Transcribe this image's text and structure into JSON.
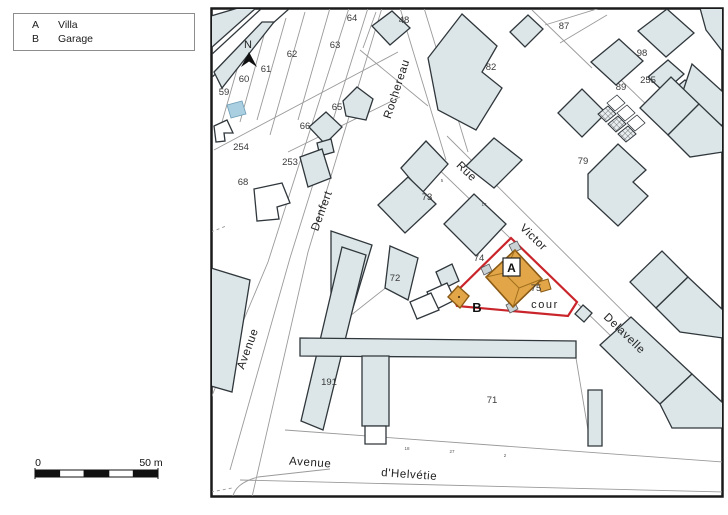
{
  "legend": {
    "items": [
      {
        "key": "A",
        "label": "Villa"
      },
      {
        "key": "B",
        "label": "Garage"
      }
    ]
  },
  "scale": {
    "zero": "0",
    "end": "50 m"
  },
  "north": "N",
  "area_label": "cour",
  "building_labels": {
    "a": "A",
    "b": "B"
  },
  "colors": {
    "building_fill": "#dce6e8",
    "building_stroke": "#30373c",
    "parcel_line": "#9a9a9a",
    "red_boundary": "#c9252b",
    "orange_fill": "#e2a648",
    "orange_stroke": "#8a5a15",
    "pool_blue": "#a9cfe0",
    "map_border": "#1a1a1a"
  },
  "street_labels": [
    {
      "text": "Rochereau",
      "x": 400,
      "y": 90,
      "rot": -72
    },
    {
      "text": "Denfert",
      "x": 325,
      "y": 212,
      "rot": -70
    },
    {
      "text": "Avenue",
      "x": 251,
      "y": 350,
      "rot": -70
    },
    {
      "text": "Rue",
      "x": 464,
      "y": 174,
      "rot": 44
    },
    {
      "text": "Victor",
      "x": 531,
      "y": 240,
      "rot": 44
    },
    {
      "text": "Delavelle",
      "x": 622,
      "y": 336,
      "rot": 44
    },
    {
      "text": "Avenue",
      "x": 310,
      "y": 466,
      "rot": 4
    },
    {
      "text": "d'Helvétie",
      "x": 409,
      "y": 478,
      "rot": 4
    }
  ],
  "parcel_labels": [
    {
      "text": "59",
      "x": 224,
      "y": 95
    },
    {
      "text": "60",
      "x": 244,
      "y": 82
    },
    {
      "text": "61",
      "x": 266,
      "y": 72
    },
    {
      "text": "62",
      "x": 292,
      "y": 57
    },
    {
      "text": "63",
      "x": 335,
      "y": 48
    },
    {
      "text": "64",
      "x": 352,
      "y": 21
    },
    {
      "text": "48",
      "x": 404,
      "y": 23
    },
    {
      "text": "87",
      "x": 564,
      "y": 29
    },
    {
      "text": "82",
      "x": 491,
      "y": 70
    },
    {
      "text": "98",
      "x": 642,
      "y": 56
    },
    {
      "text": "255",
      "x": 648,
      "y": 83
    },
    {
      "text": "89",
      "x": 621,
      "y": 90
    },
    {
      "text": "65",
      "x": 337,
      "y": 110
    },
    {
      "text": "66",
      "x": 305,
      "y": 129
    },
    {
      "text": "254",
      "x": 241,
      "y": 150
    },
    {
      "text": "253",
      "x": 290,
      "y": 165
    },
    {
      "text": "68",
      "x": 243,
      "y": 185
    },
    {
      "text": "79",
      "x": 583,
      "y": 164
    },
    {
      "text": "73",
      "x": 427,
      "y": 200
    },
    {
      "text": "74",
      "x": 479,
      "y": 261
    },
    {
      "text": "72",
      "x": 395,
      "y": 281
    },
    {
      "text": "75",
      "x": 536,
      "y": 291
    },
    {
      "text": "191",
      "x": 329,
      "y": 385
    },
    {
      "text": "71",
      "x": 492,
      "y": 403
    }
  ],
  "house_numbers": [
    {
      "text": "18",
      "x": 407,
      "y": 450
    },
    {
      "text": "27",
      "x": 452,
      "y": 453
    },
    {
      "text": "2",
      "x": 505,
      "y": 457
    },
    {
      "text": "5",
      "x": 442,
      "y": 182
    },
    {
      "text": "17",
      "x": 484,
      "y": 206
    }
  ]
}
